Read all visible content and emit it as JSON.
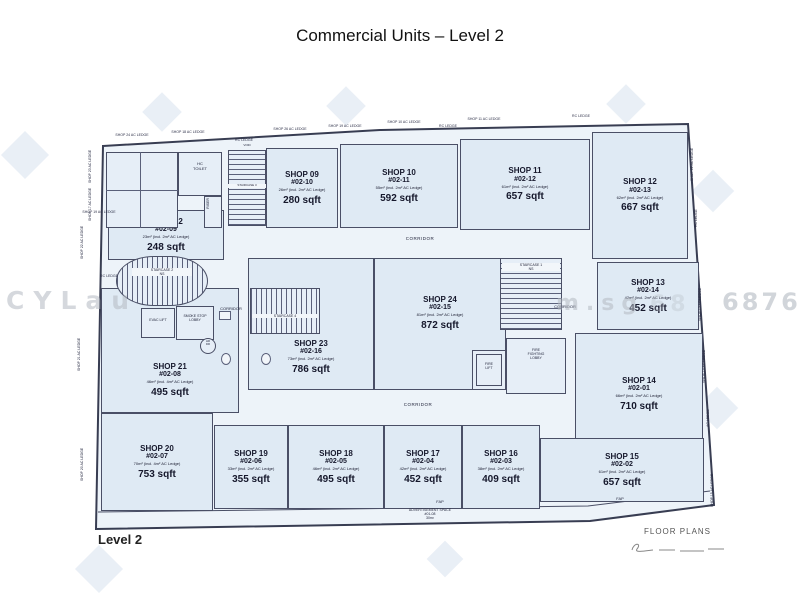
{
  "title": "Commercial Units – Level 2",
  "footer": {
    "level_label": "Level 2",
    "floor_plans_label": "FLOOR PLANS"
  },
  "watermark": {
    "fragments": [
      "CYLau",
      "m.sg",
      "68",
      "6876"
    ]
  },
  "plan": {
    "shops": [
      {
        "id": "s09",
        "name": "SHOP 09",
        "unit": "#02-10",
        "note": "26m² (incl. 2m² AC Ledge)",
        "area": "280 sqft"
      },
      {
        "id": "s10",
        "name": "SHOP 10",
        "unit": "#02-11",
        "note": "55m² (incl. 2m² AC Ledge)",
        "area": "592 sqft"
      },
      {
        "id": "s11",
        "name": "SHOP 11",
        "unit": "#02-12",
        "note": "61m² (incl. 2m² AC Ledge)",
        "area": "657 sqft"
      },
      {
        "id": "s12",
        "name": "SHOP 12",
        "unit": "#02-13",
        "note": "62m² (incl. 2m² AC Ledge)",
        "area": "667 sqft"
      },
      {
        "id": "s13",
        "name": "SHOP 13",
        "unit": "#02-14",
        "note": "42m² (incl. 2m² AC Ledge)",
        "area": "452 sqft"
      },
      {
        "id": "s14",
        "name": "SHOP 14",
        "unit": "#02-01",
        "note": "66m² (incl. 2m² AC Ledge)",
        "area": "710 sqft"
      },
      {
        "id": "s15",
        "name": "SHOP 15",
        "unit": "#02-02",
        "note": "61m² (incl. 2m² AC Ledge)",
        "area": "657 sqft"
      },
      {
        "id": "s16",
        "name": "SHOP 16",
        "unit": "#02-03",
        "note": "38m² (incl. 2m² AC Ledge)",
        "area": "409 sqft"
      },
      {
        "id": "s17",
        "name": "SHOP 17",
        "unit": "#02-04",
        "note": "42m² (incl. 2m² AC Ledge)",
        "area": "452 sqft"
      },
      {
        "id": "s18",
        "name": "SHOP 18",
        "unit": "#02-05",
        "note": "46m² (incl. 2m² AC Ledge)",
        "area": "495 sqft"
      },
      {
        "id": "s19",
        "name": "SHOP 19",
        "unit": "#02-06",
        "note": "33m² (incl. 2m² AC Ledge)",
        "area": "355 sqft"
      },
      {
        "id": "s20",
        "name": "SHOP 20",
        "unit": "#02-07",
        "note": "70m² (incl. 4m² AC Ledge)",
        "area": "753 sqft"
      },
      {
        "id": "s21",
        "name": "SHOP 21",
        "unit": "#02-08",
        "note": "46m² (incl. 4m² AC Ledge)",
        "area": "495 sqft"
      },
      {
        "id": "s22",
        "name": "SHOP 22",
        "unit": "#02-09",
        "note": "23m² (incl. 2m² AC Ledge)",
        "area": "248 sqft"
      },
      {
        "id": "s23",
        "name": "SHOP 23",
        "unit": "#02-16",
        "note": "73m² (incl. 2m² AC Ledge)",
        "area": "786 sqft"
      },
      {
        "id": "s24",
        "name": "SHOP 24",
        "unit": "#02-15",
        "note": "81m² (incl. 2m² AC Ledge)",
        "area": "872 sqft"
      }
    ],
    "labels": [
      {
        "id": "stair1",
        "text": "STAIRCASE 1\nNS"
      },
      {
        "id": "stair2",
        "text": "STAIRCASE 2\nNS"
      },
      {
        "id": "stair3",
        "text": "STAIRCASE 3"
      },
      {
        "id": "stair4",
        "text": "STAIRCASE 4"
      },
      {
        "id": "hctoilet",
        "text": "HC\nTOILET"
      },
      {
        "id": "riser",
        "text": "RISER"
      },
      {
        "id": "evaclift",
        "text": "EVAC LIFT"
      },
      {
        "id": "smokelobby",
        "text": "SMOKE STOP\nLOBBY"
      },
      {
        "id": "hrdr",
        "text": "HR\nDR"
      },
      {
        "id": "firelift",
        "text": "FIRE\nLIFT"
      },
      {
        "id": "ffl",
        "text": "FIRE\nFIGHTING\nLOBBY"
      },
      {
        "id": "void",
        "text": "VOID"
      },
      {
        "id": "c1",
        "text": "CORRIDOR"
      },
      {
        "id": "c2",
        "text": "CORRIDOR"
      },
      {
        "id": "c3",
        "text": "CORRIDOR"
      },
      {
        "id": "c4",
        "text": "CORRIDOR"
      },
      {
        "id": "fap1",
        "text": "FAP"
      },
      {
        "id": "fap2",
        "text": "FAP"
      },
      {
        "id": "adspace",
        "text": "ADVERTISEMENT SPACE\n#01-08\n30m²"
      }
    ],
    "edge_labels": [
      {
        "id": "t1",
        "text": "SHOP 24 AC LEDGE",
        "vertical": false
      },
      {
        "id": "t2",
        "text": "SHOP 18 AC LEDGE",
        "vertical": false
      },
      {
        "id": "t3",
        "text": "RC LEDGE",
        "vertical": false
      },
      {
        "id": "t4",
        "text": "SHOP 26 AC LEDGE",
        "vertical": false
      },
      {
        "id": "t5",
        "text": "SHOP 19 AC LEDGE",
        "vertical": false
      },
      {
        "id": "t6",
        "text": "SHOP 10 AC LEDGE",
        "vertical": false
      },
      {
        "id": "t7",
        "text": "RC LEDGE",
        "vertical": false
      },
      {
        "id": "t8",
        "text": "SHOP 11 AC LEDGE",
        "vertical": false
      },
      {
        "id": "t9",
        "text": "RC LEDGE",
        "vertical": false
      },
      {
        "id": "l1",
        "text": "SHOP 23 AC LEDGE",
        "vertical": true
      },
      {
        "id": "l2",
        "text": "SHOP 17 AC LEDGE",
        "vertical": true
      },
      {
        "id": "l3",
        "text": "SHOP 19 AC LEDGE",
        "vertical": false
      },
      {
        "id": "l4",
        "text": "SHOP 22 AC LEDGE",
        "vertical": true
      },
      {
        "id": "l5",
        "text": "RC LEDGE",
        "vertical": false
      },
      {
        "id": "l6",
        "text": "SHOP 21 AC LEDGE",
        "vertical": true
      },
      {
        "id": "l7",
        "text": "SHOP 20 AC LEDGE",
        "vertical": true
      },
      {
        "id": "r1",
        "text": "SHOP 12 AC LEDGE",
        "vertical": true
      },
      {
        "id": "r2",
        "text": "RC LEDGE",
        "vertical": true
      },
      {
        "id": "r3",
        "text": "SHOP 13 AC LEDGE",
        "vertical": true
      },
      {
        "id": "r4",
        "text": "SHOP 14 AC LEDGE",
        "vertical": true
      },
      {
        "id": "r5",
        "text": "AC LEDGE",
        "vertical": true
      },
      {
        "id": "r6",
        "text": "SHOP 15 AC LEDGE",
        "vertical": true
      }
    ]
  }
}
